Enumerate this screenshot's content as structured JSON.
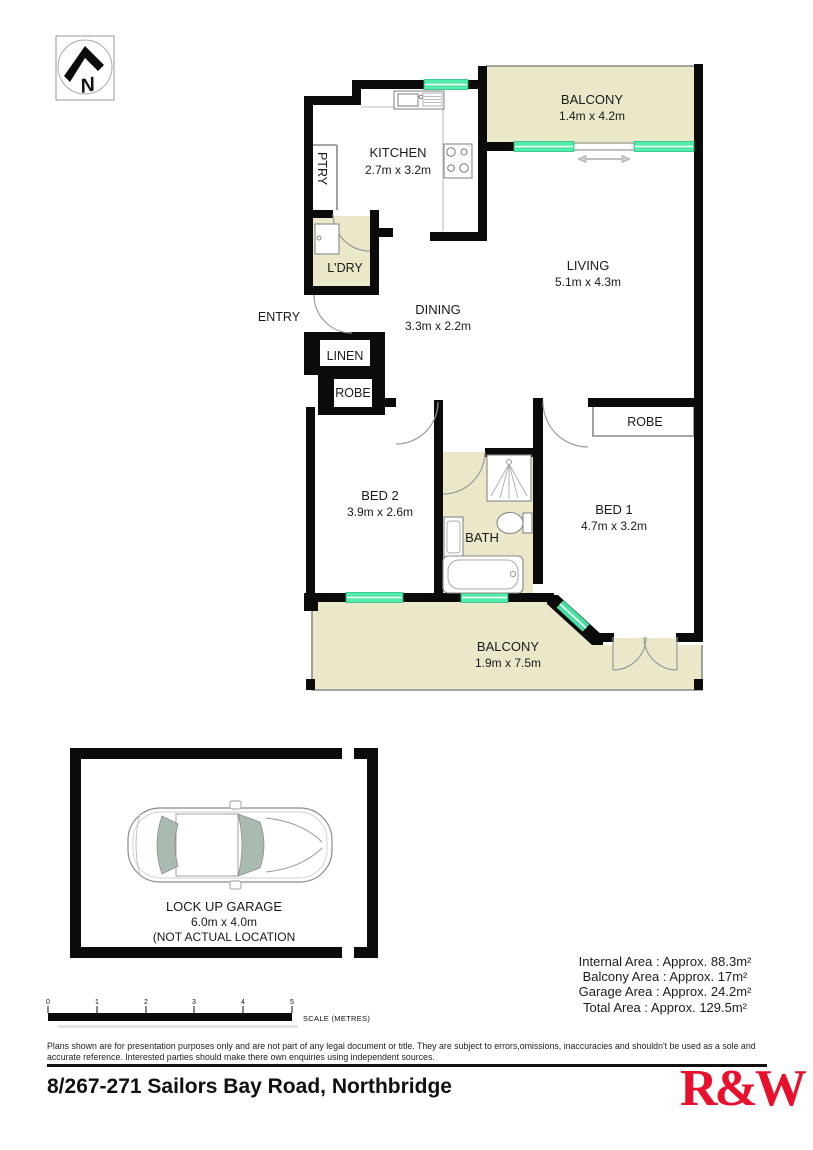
{
  "compass": {
    "letter": "N"
  },
  "plan": {
    "rooms": {
      "balcony_top": {
        "name": "BALCONY",
        "dims": "1.4m x 4.2m"
      },
      "kitchen": {
        "name": "KITCHEN",
        "dims": "2.7m x 3.2m"
      },
      "pantry": {
        "name": "PTRY"
      },
      "laundry": {
        "name": "L'DRY"
      },
      "entry": {
        "name": "ENTRY"
      },
      "dining": {
        "name": "DINING",
        "dims": "3.3m x 2.2m"
      },
      "living": {
        "name": "LIVING",
        "dims": "5.1m x 4.3m"
      },
      "linen": {
        "name": "LINEN"
      },
      "robe_hall": {
        "name": "ROBE"
      },
      "robe_bed1": {
        "name": "ROBE"
      },
      "bed2": {
        "name": "BED 2",
        "dims": "3.9m x 2.6m"
      },
      "bath": {
        "name": "BATH"
      },
      "bed1": {
        "name": "BED 1",
        "dims": "4.7m x 3.2m"
      },
      "balcony_bottom": {
        "name": "BALCONY",
        "dims": "1.9m x 7.5m"
      }
    },
    "garage": {
      "name": "LOCK UP GARAGE",
      "dims": "6.0m x 4.0m",
      "note": "(NOT ACTUAL LOCATION"
    }
  },
  "scale_bar": {
    "ticks": [
      "0",
      "1",
      "2",
      "3",
      "4",
      "5"
    ],
    "label": "SCALE (METRES)"
  },
  "areas": {
    "internal": "Internal Area : Approx. 88.3m²",
    "balcony": "Balcony Area : Approx. 17m²",
    "garage": "Garage Area : Approx. 24.2m²",
    "total": "Total Area : Approx. 129.5m²"
  },
  "disclaimer": "Plans shown are for presentation purposes only and are not part of any legal document or title. They are subject to errors,omissions, inaccuracies and shouldn't be used as a sole and accurate reference. Interested parties should make there own enquiries using independent sources.",
  "footer": {
    "address": "8/267-271 Sailors Bay Road, Northbridge",
    "logo": "R&W"
  },
  "colors": {
    "balcony_fill": "#EAE8C9",
    "window": "#52EBA9",
    "wall": "#0b0b0b",
    "logo_red": "#E8112D"
  }
}
